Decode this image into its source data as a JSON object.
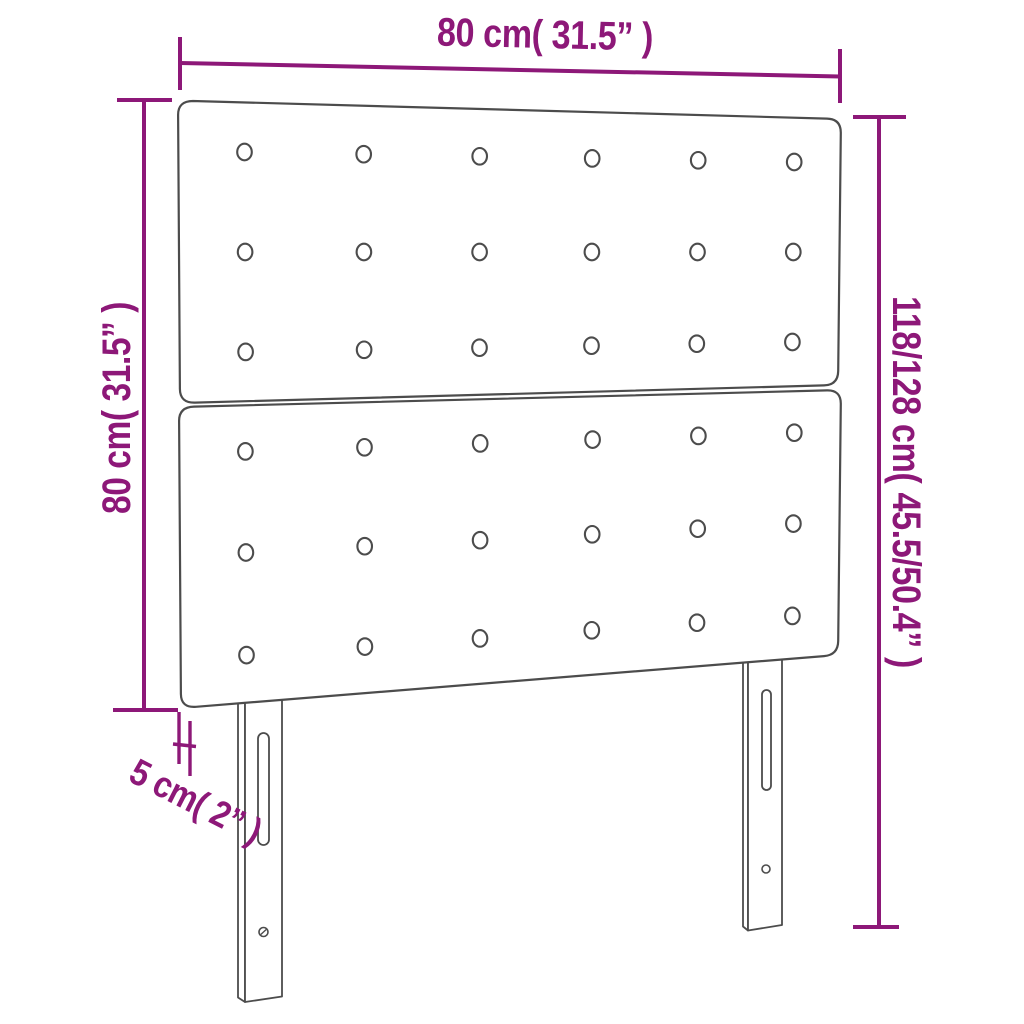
{
  "diagram": {
    "type": "product-dimension-drawing",
    "labels": {
      "width_top": "80 cm( 31.5” )",
      "height_left": "80 cm( 31.5” )",
      "height_right": "118/128 cm( 45.5/50.4” )",
      "thickness": "5 cm( 2” )"
    },
    "colors": {
      "dimension_accent": "#8d1878",
      "drawing_outline": "#4c4c4c",
      "background": "#ffffff"
    },
    "structure": {
      "panels": 2,
      "button_rows_per_panel": 3,
      "button_columns_per_panel": 6,
      "legs": 2,
      "slots_per_leg": 1,
      "screw_holes_per_leg": 1
    }
  }
}
